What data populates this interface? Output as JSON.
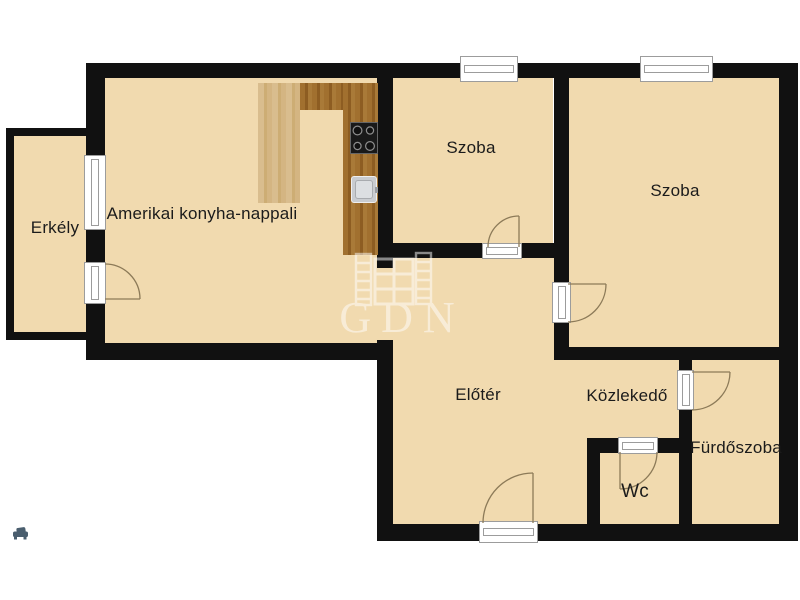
{
  "rooms": {
    "balcony": {
      "label": "Erkély"
    },
    "living": {
      "label": "Amerikai konyha-nappali"
    },
    "room1": {
      "label": "Szoba"
    },
    "room2": {
      "label": "Szoba"
    },
    "hall": {
      "label": "Előtér"
    },
    "corridor": {
      "label": "Közlekedő"
    },
    "bathroom": {
      "label": "Fürdőszoba"
    },
    "wc": {
      "label": "Wc"
    }
  },
  "watermark": {
    "text": "GDN"
  },
  "icons": {
    "bottom_left": "sofa-icon"
  },
  "colors": {
    "background": "#FFFFFF",
    "floor": "#F1DAAF",
    "wall": "#111111",
    "wood_light": "#D9BD8E",
    "wood_dark": "#A1702F",
    "stove": "#191919",
    "sink": "#C9CCD0",
    "door_arc": "#8C7A58",
    "watermark": "#FFFFFF",
    "icon": "#4A5E6E",
    "label_text": "#1B1B1B"
  }
}
